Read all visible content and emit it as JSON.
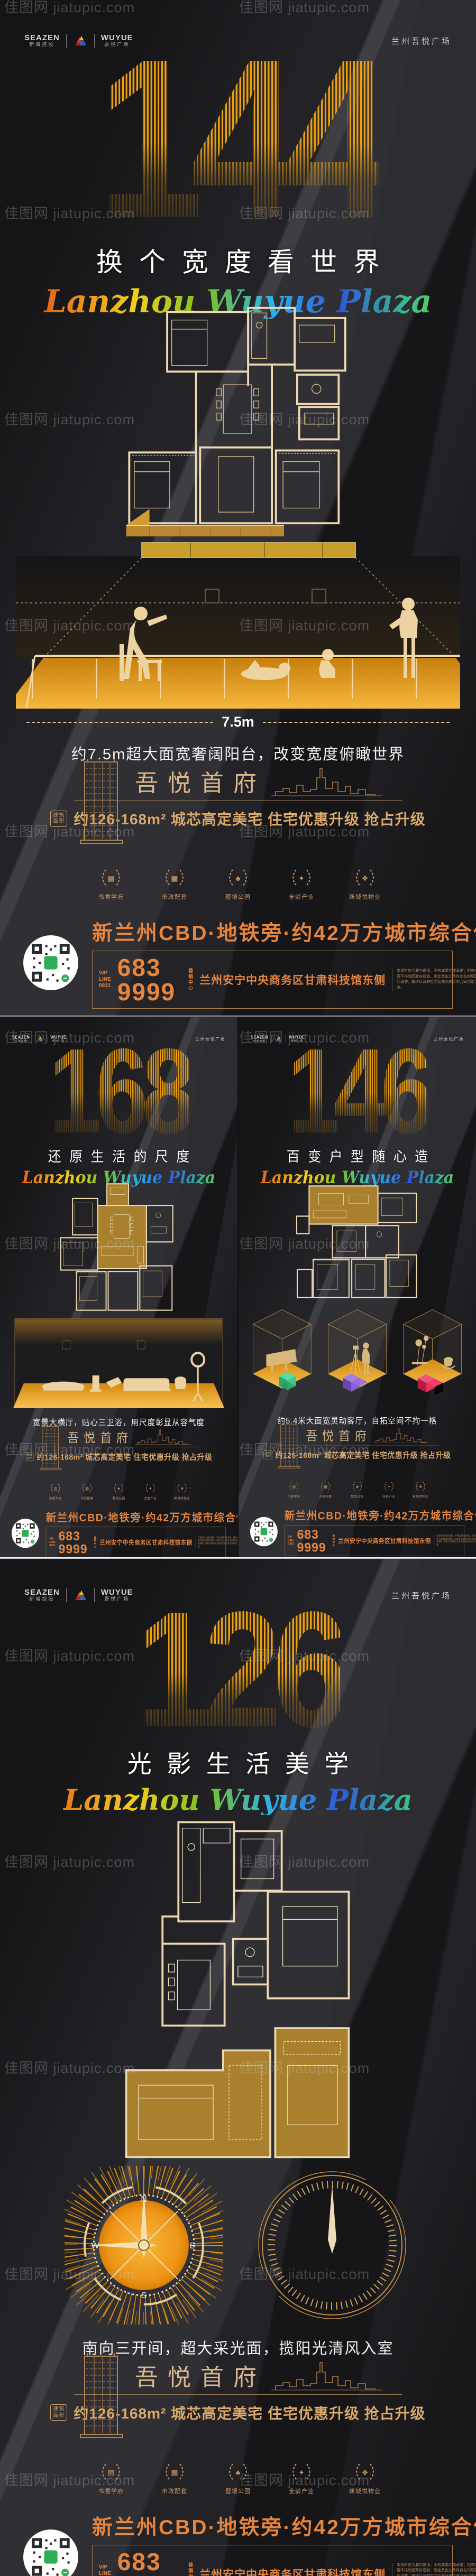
{
  "watermark": {
    "text": "佳图网 jiatupic.com"
  },
  "header": {
    "brand1_en": "SEAZEN",
    "brand1_cn": "新城控股",
    "brand2_en": "WUYUE",
    "brand2_cn": "吾悦广场",
    "right": "兰州吾悦广场"
  },
  "posters": [
    {
      "number": "144",
      "headline": "换个宽度看世界",
      "script": "Lanzhou Wuyue Plaza",
      "caption": "约7.5m超大面宽奢阔阳台，改变宽度俯瞰世界",
      "measure": "7.5m"
    },
    {
      "number": "168",
      "headline": "还原生活的尺度",
      "script": "Lanzhou Wuyue Plaza",
      "caption": "宽景大横厅，贴心三卫浴，用尺度彰显从容气度"
    },
    {
      "number": "146",
      "headline": "百变户型随心造",
      "script": "Lanzhou Wuyue Plaza",
      "caption": "约5.4米大面宽灵动客厅，自拓空间不拘一格"
    },
    {
      "number": "126",
      "headline": "光影生活美学",
      "script": "Lanzhou Wuyue Plaza",
      "caption": "南向三开间，超大采光面，揽阳光清风入室"
    }
  ],
  "compass": {
    "n": "N",
    "s": "S",
    "e": "E",
    "w": "W"
  },
  "footer_common": {
    "project_name": "吾悦首府",
    "area_badge": "建筑\n面积",
    "area_text": "约126-168m²  城芯高定美宅  住宅优惠升级  抢占升级",
    "icons": [
      {
        "label": "书香学府",
        "glyph": "▤"
      },
      {
        "label": "市政配套",
        "glyph": "▦"
      },
      {
        "label": "墅境公园",
        "glyph": "♣"
      },
      {
        "label": "全龄产业",
        "glyph": "✦"
      },
      {
        "label": "新城悦物业",
        "glyph": "❖"
      }
    ],
    "banner_headline": "新兰州CBD·地铁旁·约42万方城市综合体",
    "vip_label": "VIP LINE",
    "vip_code": "0931",
    "phone": "683 9999",
    "address_label": "营销\n中心",
    "address": "兰州安宁中央商务区甘肃科技馆东侧",
    "disclaimer": "本资料仅为要约邀请，不构成要约或承诺；相关内容不排除因政府规划、规定及出让条件变化的原因而调整，最终以政府批文及商品房买卖合同约定为准。"
  },
  "colors": {
    "number_gold": "#eda011",
    "banner_orange": "#e8853c",
    "plan_cream": "#ecd9b2",
    "highlight_gold": "#a8802e",
    "cube_green": "#3ecb8a",
    "cube_purple": "#8a5fd6",
    "cube_red": "#e8315b",
    "qr_green": "#2fae57"
  }
}
